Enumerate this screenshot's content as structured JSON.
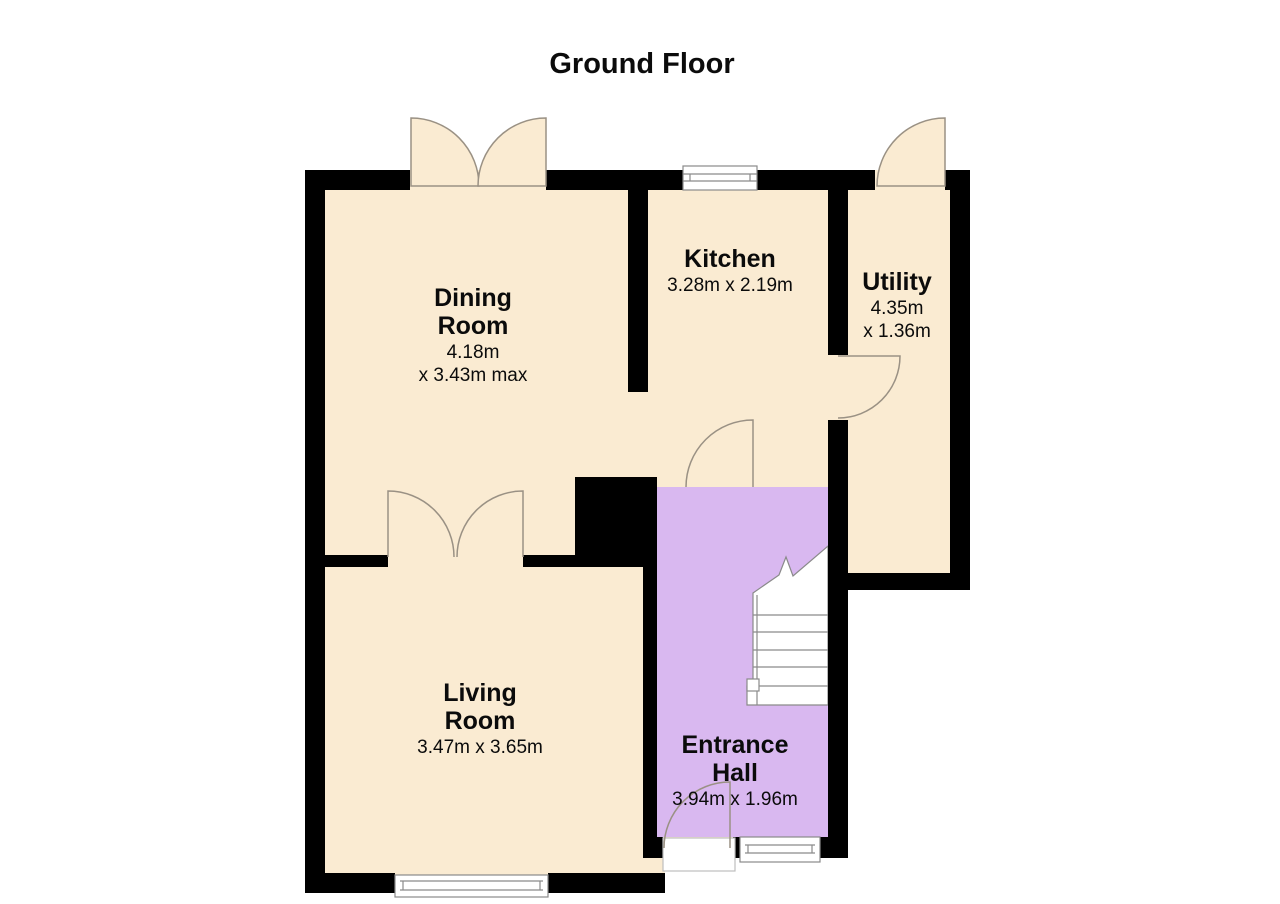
{
  "title": "Ground Floor",
  "rooms": {
    "dining": {
      "name": "Dining\nRoom",
      "dims": "4.18m\nx 3.43m max"
    },
    "kitchen": {
      "name": "Kitchen",
      "dims": "3.28m x 2.19m"
    },
    "utility": {
      "name": "Utility",
      "dims": "4.35m\nx 1.36m"
    },
    "living": {
      "name": "Living\nRoom",
      "dims": "3.47m x 3.65m"
    },
    "hall": {
      "name": "Entrance\nHall",
      "dims": "3.94m x 1.96m"
    }
  },
  "colors": {
    "room_fill": "#FAEBD2",
    "hall_fill": "#D9B8F0",
    "wall": "#000000",
    "line": "#9A9184",
    "window_line": "#8A8A8A",
    "text": "#0B0B0B"
  }
}
